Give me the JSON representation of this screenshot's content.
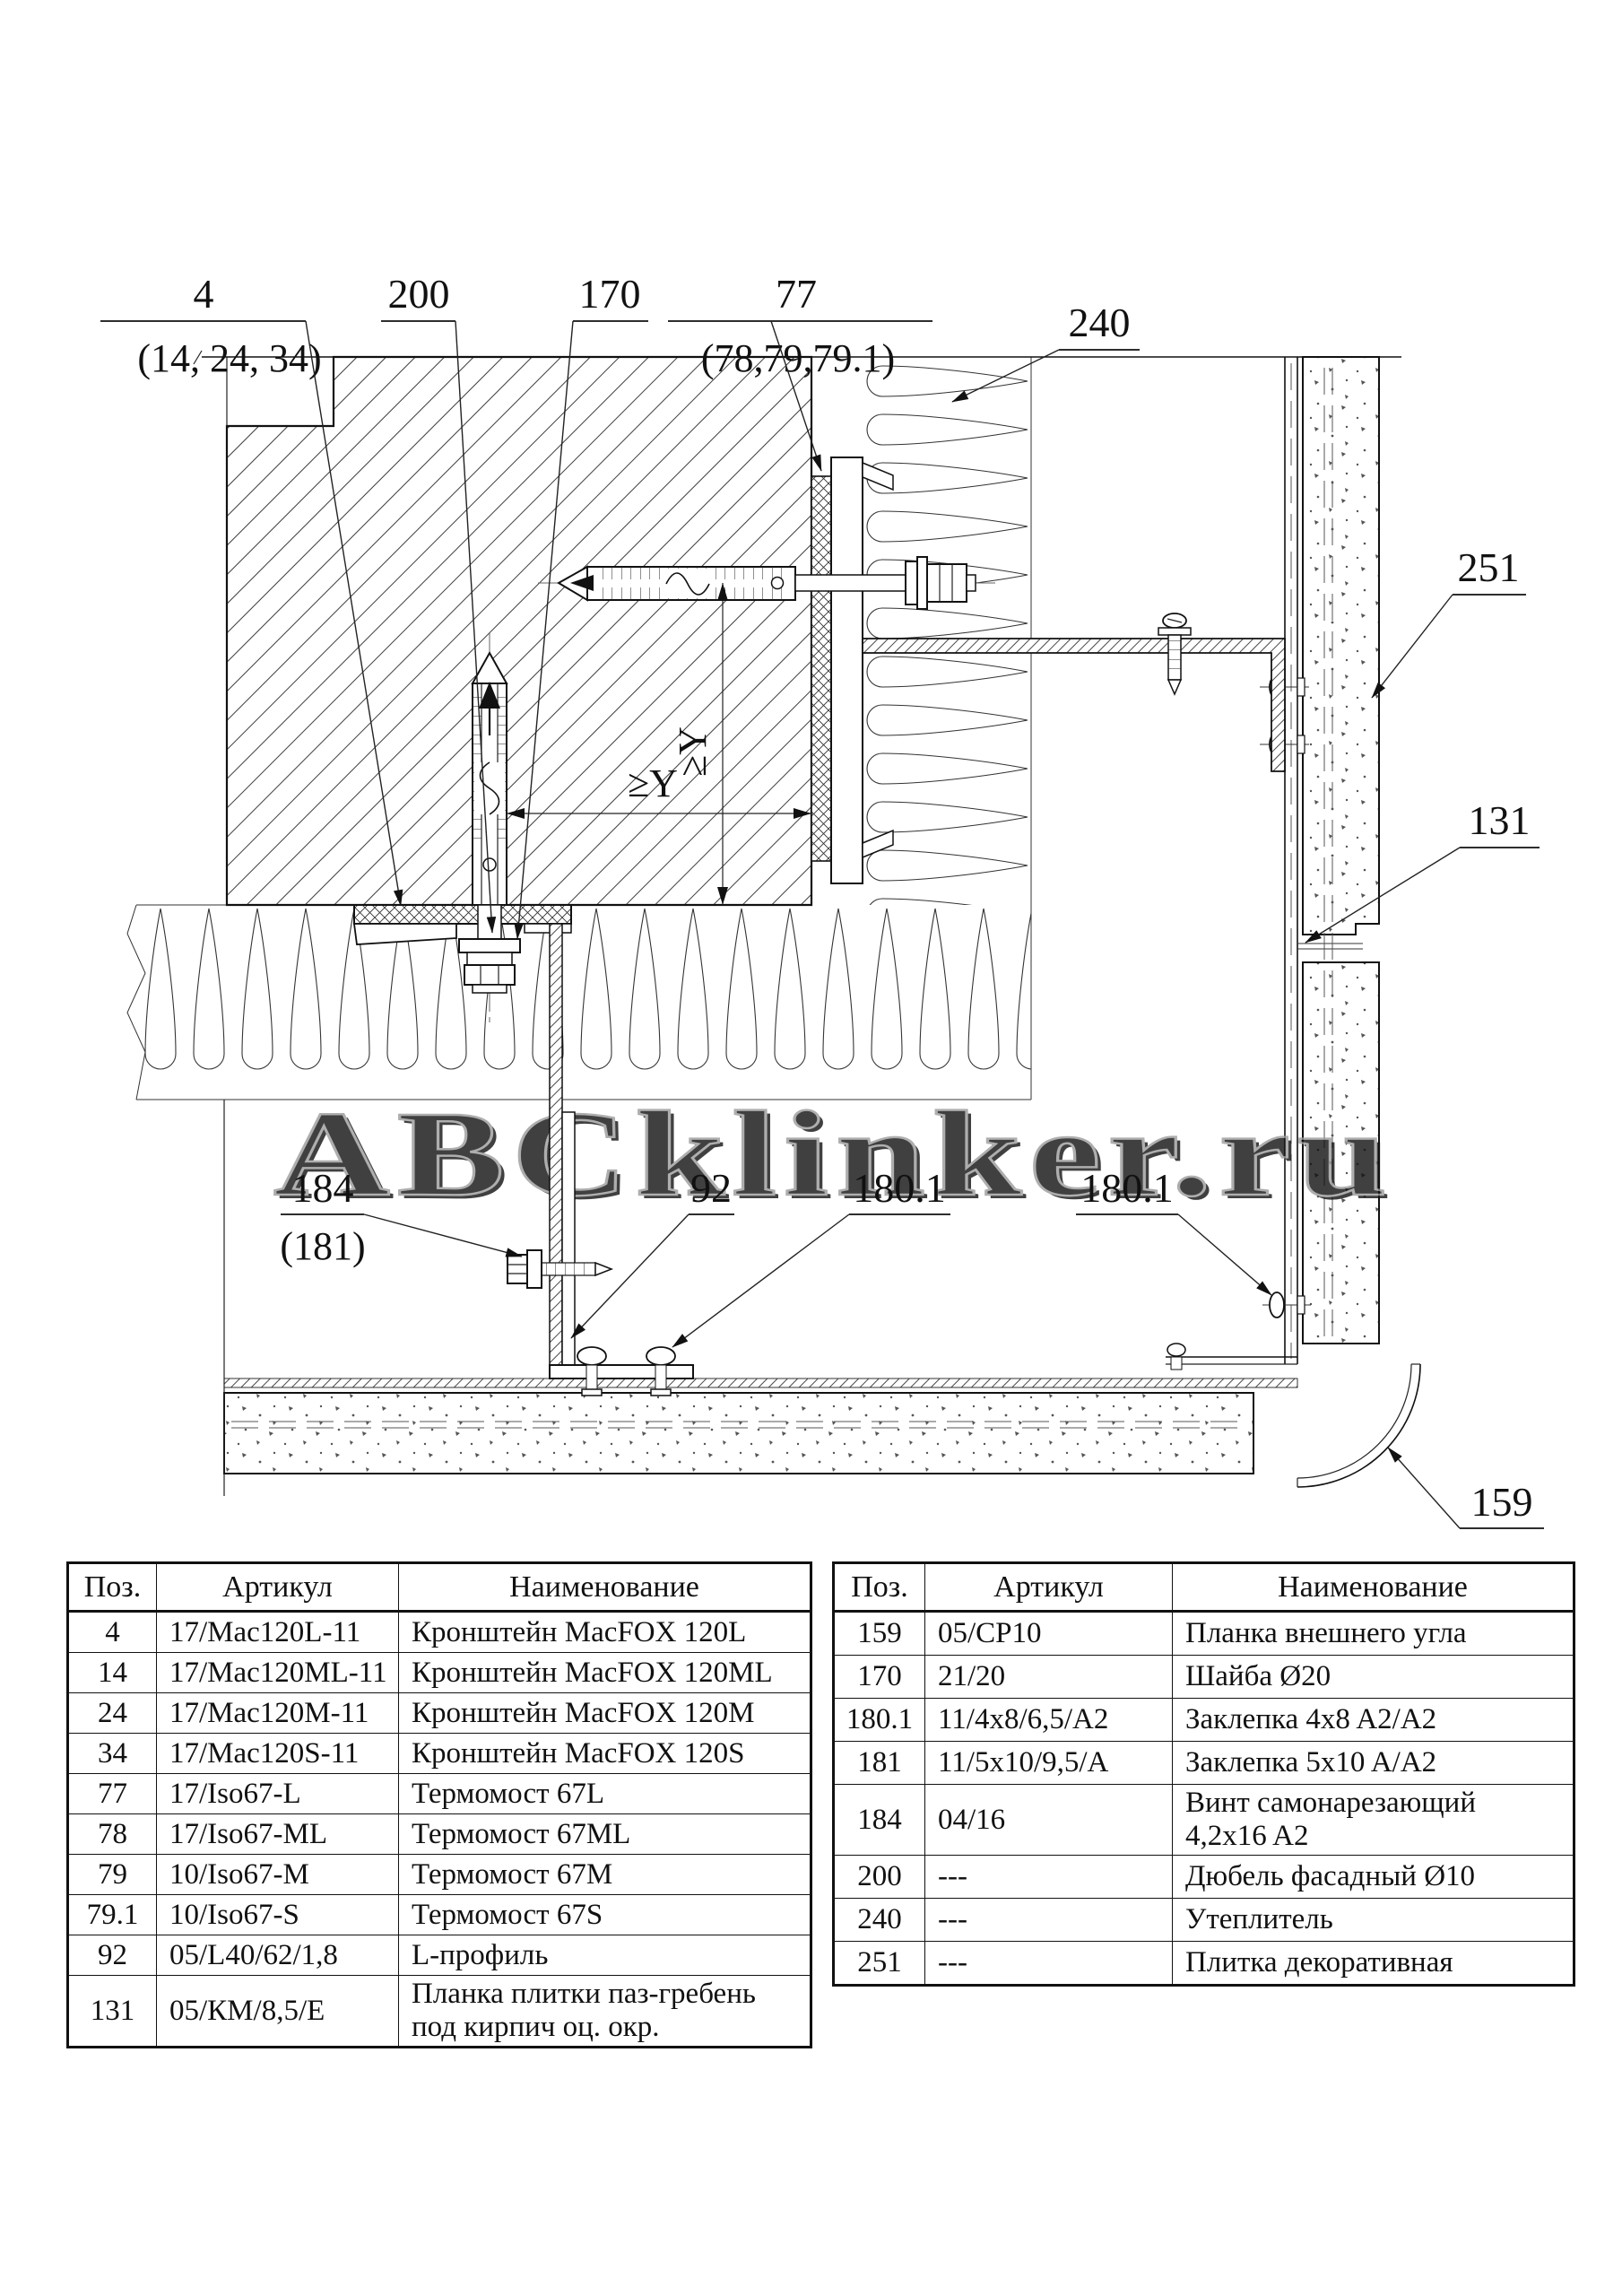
{
  "drawing": {
    "callouts": {
      "bracket": {
        "num": "4",
        "alt": "(14, 24, 34)"
      },
      "dowel": {
        "num": "200"
      },
      "washer": {
        "num": "170"
      },
      "thermobridge": {
        "num": "77",
        "alt": "(78,79,79.1)"
      },
      "insulation": {
        "num": "240"
      },
      "tile": {
        "num": "251"
      },
      "tile_strip": {
        "num": "131"
      },
      "screw": {
        "num": "184",
        "alt": "(181)"
      },
      "l_profile": {
        "num": "92"
      },
      "rivet_left": {
        "num": "180.1"
      },
      "rivet_right": {
        "num": "180.1"
      },
      "corner_strip": {
        "num": "159"
      }
    },
    "dimensions": {
      "vertical": "≥Y",
      "horizontal": "≥Y"
    },
    "watermark": "ABCklinker.ru"
  },
  "tables": {
    "left": {
      "headers": [
        "Поз.",
        "Артикул",
        "Наименование"
      ],
      "rows": [
        {
          "pos": "4",
          "art": "17/Mac120L-11",
          "name": "Кронштейн MacFOX 120L"
        },
        {
          "pos": "14",
          "art": "17/Mac120ML-11",
          "name": "Кронштейн MacFOX 120ML"
        },
        {
          "pos": "24",
          "art": "17/Mac120M-11",
          "name": "Кронштейн MacFOX 120M"
        },
        {
          "pos": "34",
          "art": "17/Mac120S-11",
          "name": "Кронштейн MacFOX 120S"
        },
        {
          "pos": "77",
          "art": "17/Iso67-L",
          "name": "Термомост 67L"
        },
        {
          "pos": "78",
          "art": "17/Iso67-ML",
          "name": "Термомост 67ML"
        },
        {
          "pos": "79",
          "art": "10/Iso67-M",
          "name": "Термомост 67M"
        },
        {
          "pos": "79.1",
          "art": "10/Iso67-S",
          "name": "Термомост 67S"
        },
        {
          "pos": "92",
          "art": "05/L40/62/1,8",
          "name": "L-профиль"
        },
        {
          "pos": "131",
          "art": "05/КМ/8,5/Е",
          "name": "Планка плитки паз-гребень\nпод кирпич оц. окр."
        }
      ]
    },
    "right": {
      "headers": [
        "Поз.",
        "Артикул",
        "Наименование"
      ],
      "rows": [
        {
          "pos": "159",
          "art": "05/CP10",
          "name": "Планка внешнего угла"
        },
        {
          "pos": "170",
          "art": "21/20",
          "name": "Шайба Ø20"
        },
        {
          "pos": "180.1",
          "art": "11/4x8/6,5/A2",
          "name": "Заклепка 4x8 A2/A2"
        },
        {
          "pos": "181",
          "art": "11/5x10/9,5/A",
          "name": "Заклепка 5x10 A/A2"
        },
        {
          "pos": "184",
          "art": "04/16",
          "name": "Винт самонарезающий\n4,2x16 A2"
        },
        {
          "pos": "200",
          "art": "---",
          "name": "Дюбель фасадный Ø10"
        },
        {
          "pos": "240",
          "art": "---",
          "name": "Утеплитель"
        },
        {
          "pos": "251",
          "art": "---",
          "name": "Плитка декоративная"
        }
      ]
    }
  }
}
